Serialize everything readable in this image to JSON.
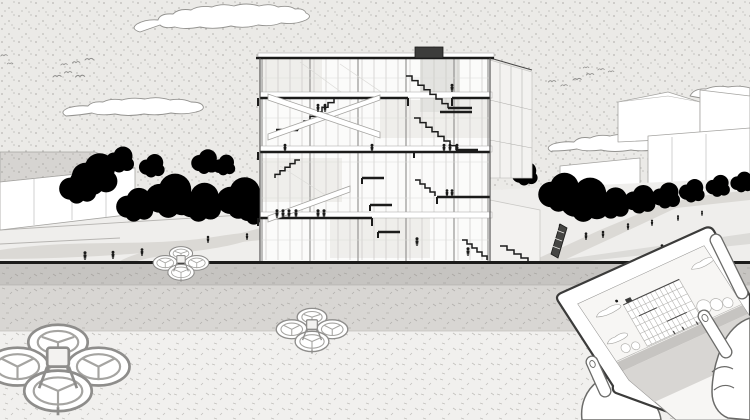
{
  "scene": {
    "kind": "architectural-illustration",
    "description": "Monochrome stippled architectural visualization: sectional perspective of a six-storey building on a landscaped plaza behind a riverside wall, with three delivery drones in the foreground and two hands holding a tablet that displays a miniature of the same building scene",
    "sky": {
      "clouds": 4,
      "bird_flocks": 2,
      "birds_total": 15
    },
    "building": {
      "floors": 6,
      "stair_flights": 6,
      "has_roof_box": true,
      "occupants": 18
    },
    "site": {
      "trees_left": 11,
      "trees_right": 9,
      "background_buildings": 4,
      "pedestrians": 14,
      "dark_sculpture": true,
      "terraced_plaza": true
    },
    "drones": [
      {
        "id": "drone-large",
        "position": "bottom-left foreground"
      },
      {
        "id": "drone-mid",
        "position": "center foreground"
      },
      {
        "id": "drone-wall",
        "position": "perched on wall left of building"
      }
    ],
    "tablet": {
      "held_by": "two hands",
      "screen_content": "miniature of the building scene",
      "tilt": "rotated about -26 degrees"
    }
  },
  "colors": {
    "skyBase": "#ebeae7",
    "stipple": "#8f8d89",
    "tick": "#a9a7a3",
    "tickLight": "#c2c0bc",
    "band1": "#c6c4c1",
    "band2": "#d8d6d3",
    "fg": "#f1f0ee",
    "cloudFill": "#ffffff",
    "cloudStroke": "#949390",
    "white": "#ffffff",
    "ink": "#1b1b1a",
    "lineDark": "#4a4948",
    "lineMid": "#8e8d8b",
    "sketch": "#a5a4a1",
    "mullion": "#c9c8c5",
    "glass": "#dcdbd8",
    "annex": "#f3f2f0",
    "plaza": "#efeeec",
    "path": "#dbd9d5",
    "terrace": "#b7b5b2",
    "structure": "#d6d4d1",
    "rampLine": "#b0afac",
    "roofBox": "#3c3c3b",
    "sculpture": "#454543",
    "tabletStroke": "#3b3b3a",
    "handStroke": "#6b6b69",
    "screenSky": "#f7f6f4",
    "miniLine": "#b5b4b1"
  }
}
